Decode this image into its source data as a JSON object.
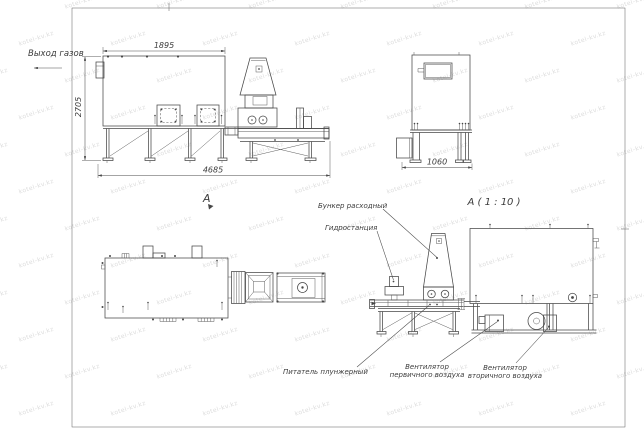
{
  "labels": {
    "gas_outlet": "Выход газов",
    "view_a": "А",
    "section_title": "А ( 1 : 10 )",
    "hopper": "Бункер расходный",
    "hydrostation": "Гидростанция",
    "feeder": "Питатель плунжерный",
    "primary_fan": [
      "Вентилятор",
      "первичного воздуха"
    ],
    "secondary_fan": [
      "Вентилятор",
      "вторичного воздуха"
    ]
  },
  "dimensions": {
    "front_width_top": "1895",
    "front_height": "2705",
    "front_length_total": "4685",
    "side_width": "1060"
  },
  "watermark": {
    "text": "kotel-kv.kz"
  },
  "colors": {
    "line": "#474747",
    "text": "#3c3c3c",
    "watermark": "#d4d4d4",
    "background": "#ffffff"
  }
}
